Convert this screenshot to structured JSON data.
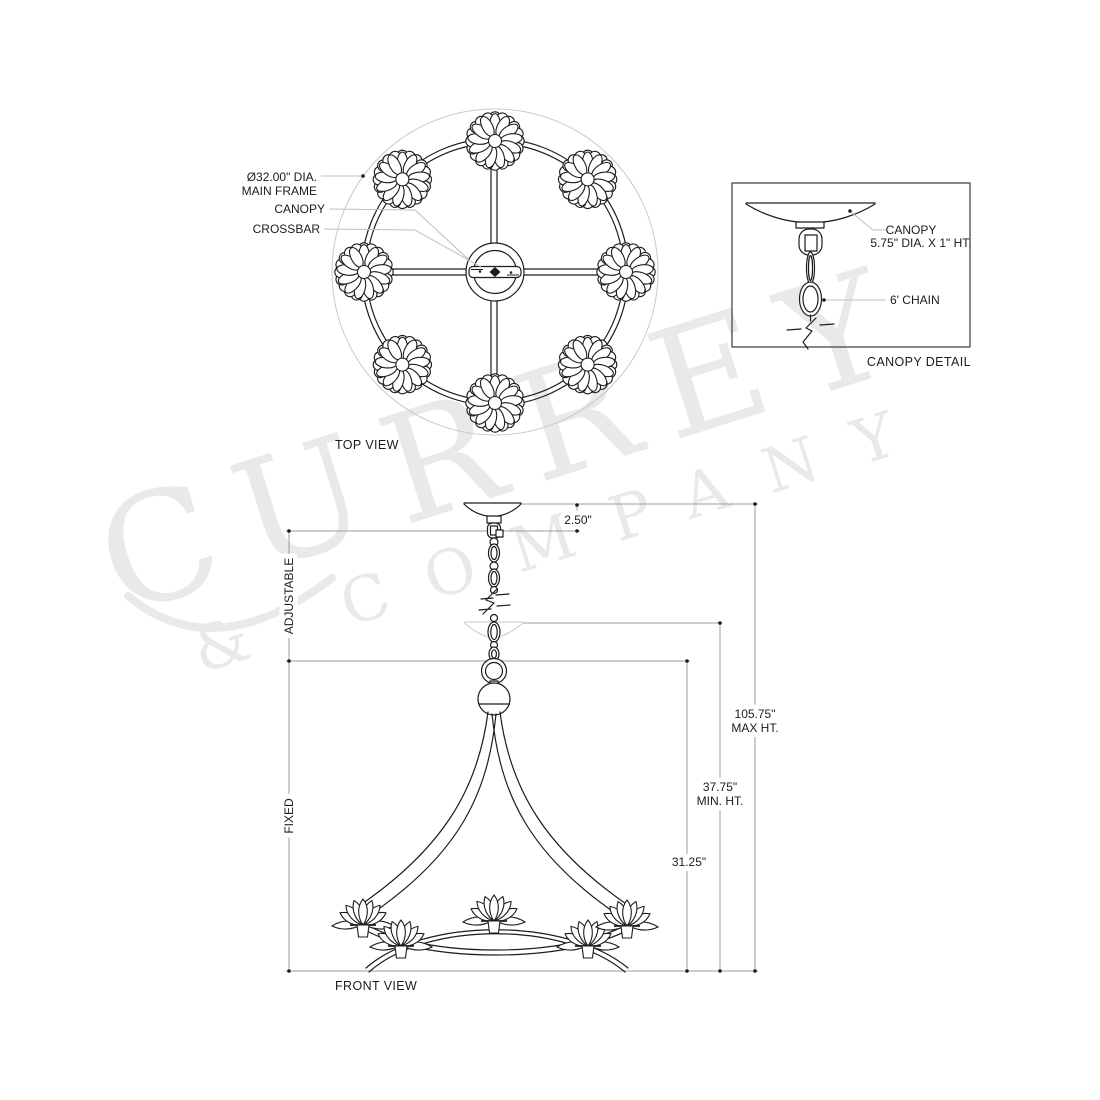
{
  "watermark": {
    "line1": "CURREY",
    "line2": "& COMPANY",
    "color": "#e9e9e9"
  },
  "top_view": {
    "title": "TOP VIEW",
    "callouts": {
      "main_frame_l1": "Ø32.00\" DIA.",
      "main_frame_l2": "MAIN FRAME",
      "canopy": "CANOPY",
      "crossbar": "CROSSBAR"
    },
    "flower_count": 8
  },
  "canopy_detail": {
    "title": "CANOPY DETAIL",
    "canopy_l1": "CANOPY",
    "canopy_l2": "5.75\" DIA. X 1\" HT.",
    "chain": "6' CHAIN"
  },
  "front_view": {
    "title": "FRONT VIEW",
    "flower_count": 5,
    "dims": {
      "drop": "2.50\"",
      "adjustable": "ADJUSTABLE",
      "fixed": "FIXED",
      "max_l1": "105.75\"",
      "max_l2": "MAX HT.",
      "min_l1": "37.75\"",
      "min_l2": "MIN. HT.",
      "body": "31.25\""
    }
  },
  "colors": {
    "line": "#1c1c1c",
    "dimension": "#9c9c9c",
    "leader": "#bfbfbf",
    "ghost": "#c9c9c9",
    "watermark": "#e9e9e9"
  }
}
